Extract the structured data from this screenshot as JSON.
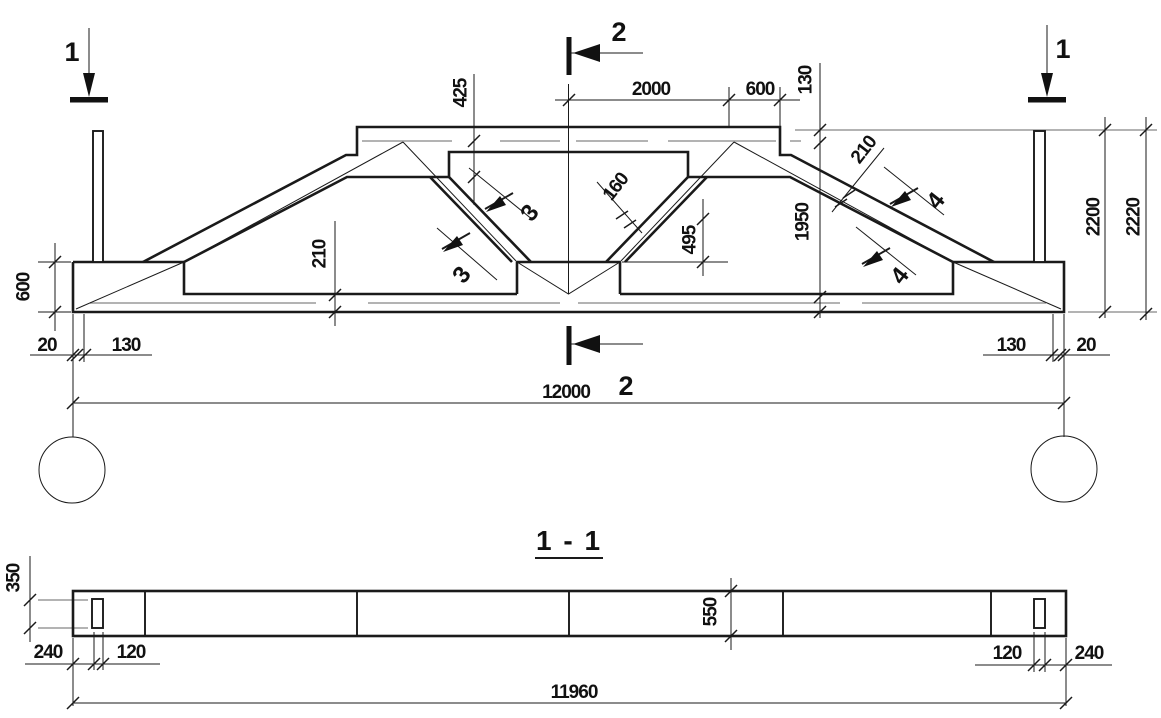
{
  "labels": {
    "section1": "1",
    "section2": "2",
    "flag3": "3",
    "flag4": "4",
    "section_title": "1 - 1"
  },
  "elevation_dims": {
    "span": "12000",
    "top_2000": "2000",
    "top_600": "600",
    "slab_thk_130": "130",
    "haunch_425": "425",
    "diag_thk_160": "160",
    "gap_495": "495",
    "chord_thk_210": "210",
    "top_chord_thk_210": "210",
    "web_1950": "1950",
    "height_2200": "2200",
    "height_2220": "2220",
    "block_600": "600",
    "edge_20": "20",
    "bearing_130": "130"
  },
  "section_dims": {
    "length": "11960",
    "loop_height_350": "350",
    "end_offset_240": "240",
    "loop_width_120": "120",
    "depth_550": "550"
  },
  "colors": {
    "line": "#1a1a1a",
    "hidden_line": "#9a9a9a",
    "background": "#ffffff"
  }
}
